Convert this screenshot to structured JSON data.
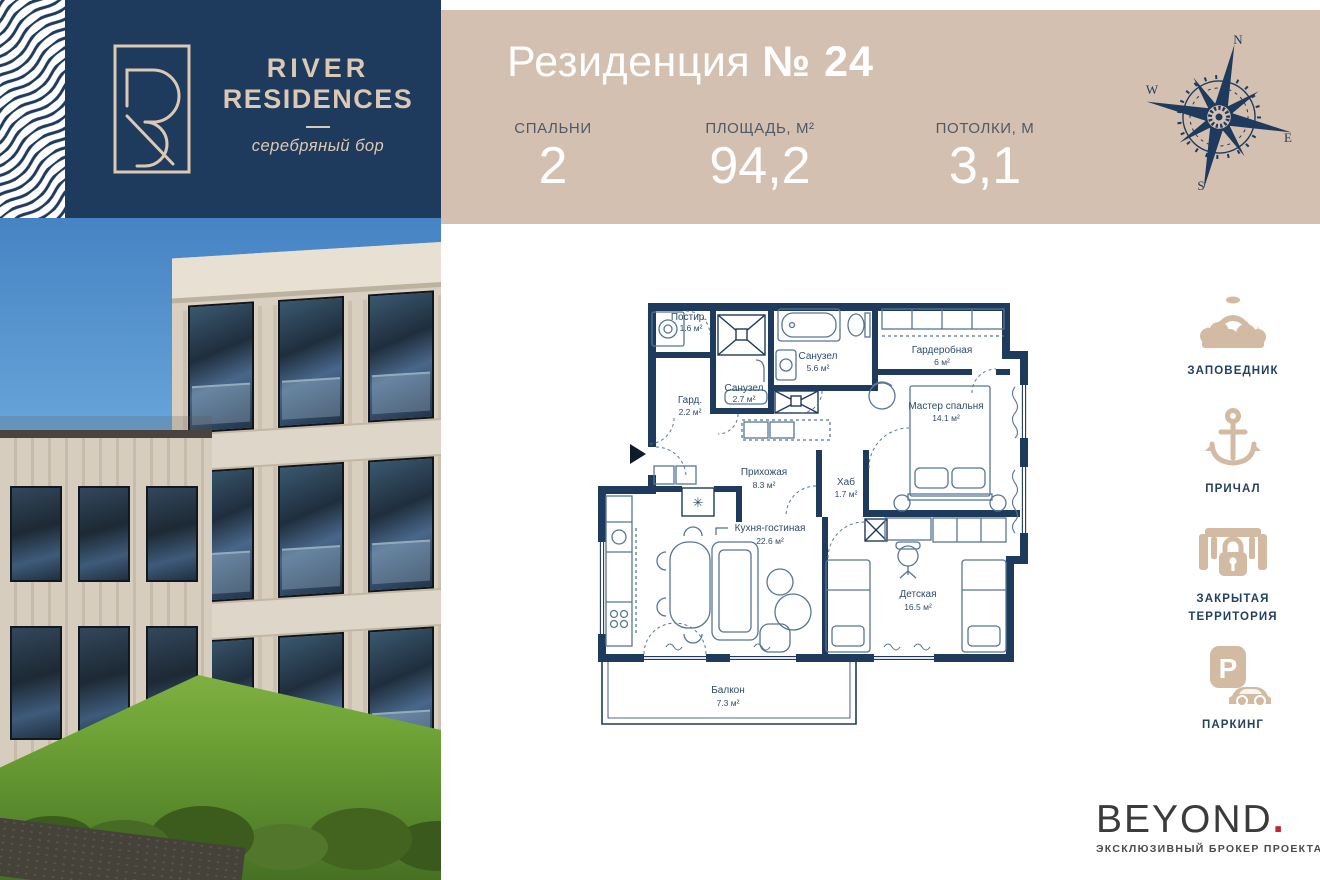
{
  "brand": {
    "line1": "RIVER",
    "line2": "RESIDENCES",
    "subtitle": "серебряный бор"
  },
  "unit": {
    "title": "Резиденция",
    "number": "№ 24",
    "stats": [
      {
        "label": "СПАЛЬНИ",
        "value": "2"
      },
      {
        "label": "ПЛОЩАДЬ, М²",
        "value": "94,2"
      },
      {
        "label": "ПОТОЛКИ, М",
        "value": "3,1"
      }
    ]
  },
  "compass": {
    "north": "N",
    "west": "W",
    "east": "E",
    "south": "S"
  },
  "floorplan": {
    "rooms": [
      {
        "name": "Постир.",
        "area": "1.6 м²"
      },
      {
        "name": "Санузел",
        "area": "2.7 м²"
      },
      {
        "name": "Гард.",
        "area": "2.2 м²"
      },
      {
        "name": "Санузел",
        "area": "5.6 м²"
      },
      {
        "name": "Гардеробная",
        "area": "6 м²"
      },
      {
        "name": "Мастер спальня",
        "area": "14.1 м²"
      },
      {
        "name": "Прихожая",
        "area": "8.3 м²"
      },
      {
        "name": "Хаб",
        "area": "1.7 м²"
      },
      {
        "name": "Кухня-гостиная",
        "area": "22.6 м²"
      },
      {
        "name": "Детская",
        "area": "16.5 м²"
      },
      {
        "name": "Балкон",
        "area": "7.3 м²"
      }
    ]
  },
  "amenities": [
    {
      "label": "ЗАПОВЕДНИК"
    },
    {
      "label": "ПРИЧАЛ"
    },
    {
      "label": "ЗАКРЫТАЯ ТЕРРИТОРИЯ"
    },
    {
      "label": "ПАРКИНГ"
    }
  ],
  "parking_letter": "P",
  "broker": {
    "name": "BEYOND",
    "dot": ".",
    "tagline": "ЭКСКЛЮЗИВНЫЙ БРОКЕР ПРОЕКТА"
  },
  "colors": {
    "navy": "#1e3a5c",
    "beige_band": "#d3c0b0",
    "icon_beige": "#d2bba2",
    "accent_red": "#c0233c"
  }
}
